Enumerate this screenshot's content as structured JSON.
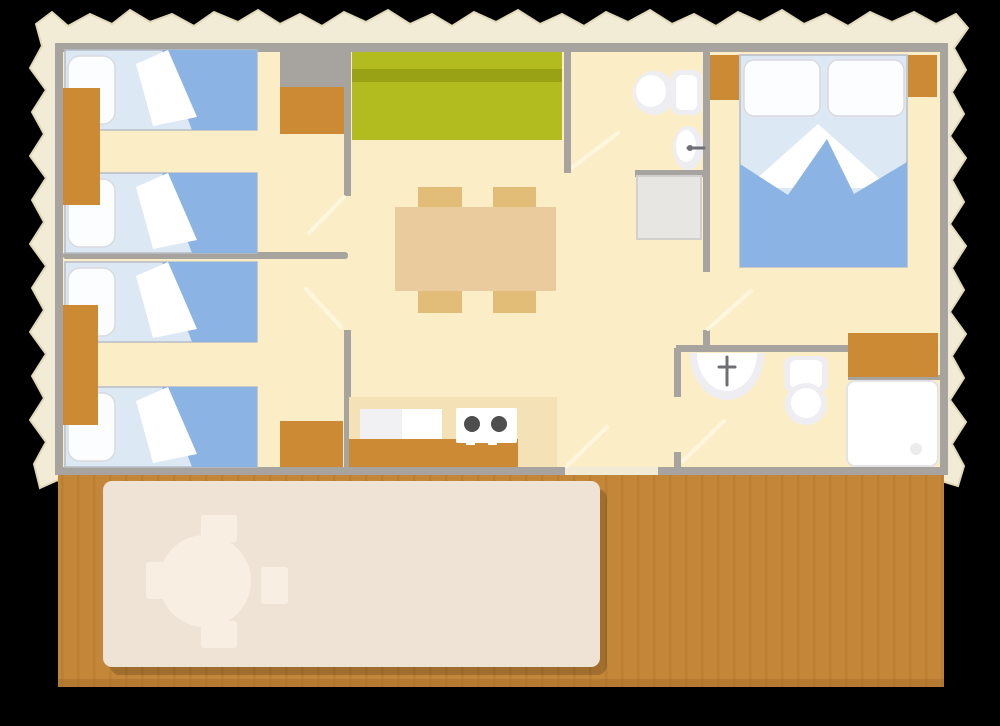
{
  "canvas": {
    "width": 1000,
    "height": 726,
    "background": "#000000"
  },
  "scene": {
    "type": "floor-plan",
    "rooms": [
      "bedroom-1",
      "bedroom-2",
      "living-dining-room",
      "kitchen",
      "wc",
      "bathroom",
      "master-bedroom",
      "terrace"
    ],
    "furniture_counts": {
      "single_beds": 4,
      "double_beds": 1,
      "wood_cabinets": 7,
      "dining_chairs": 4,
      "terrace_chairs": 4
    }
  },
  "colors": {
    "paper": "#f2ecd7",
    "paper_edge": "#e2d9ba",
    "wall": "#a7a39f",
    "floor": "#fbeec7",
    "kitchen_floor": "#f5e1b6",
    "bed_sheet": "#dce9f5",
    "bed_blanket": "#8bb3e4",
    "bed_outline": "#b7bcc6",
    "pillow": "#fcfdfe",
    "pillow_edge": "#d9dade",
    "fold_white": "#ffffff",
    "furniture_wood": "#cd8a35",
    "sofa": "#b2bc1f",
    "sofa_stripe": "#99a214",
    "table": "#eacb9d",
    "chair": "#e2bd77",
    "fixture": "#ffffff",
    "fixture_shade": "#eeeef2",
    "unit_gray": "#e8e6e2",
    "unit_gray_edge": "#d2d0cc",
    "burner": "#4e4e4e",
    "terrace_wood": "#c4873a",
    "terrace_plank": "#b67c2f",
    "terrace_edge": "#a96f2a",
    "mat": "#eee3d5",
    "terrace_furniture": "#f8efe2",
    "door_swing": "#fff7e0",
    "tap": "#6f6f73"
  }
}
